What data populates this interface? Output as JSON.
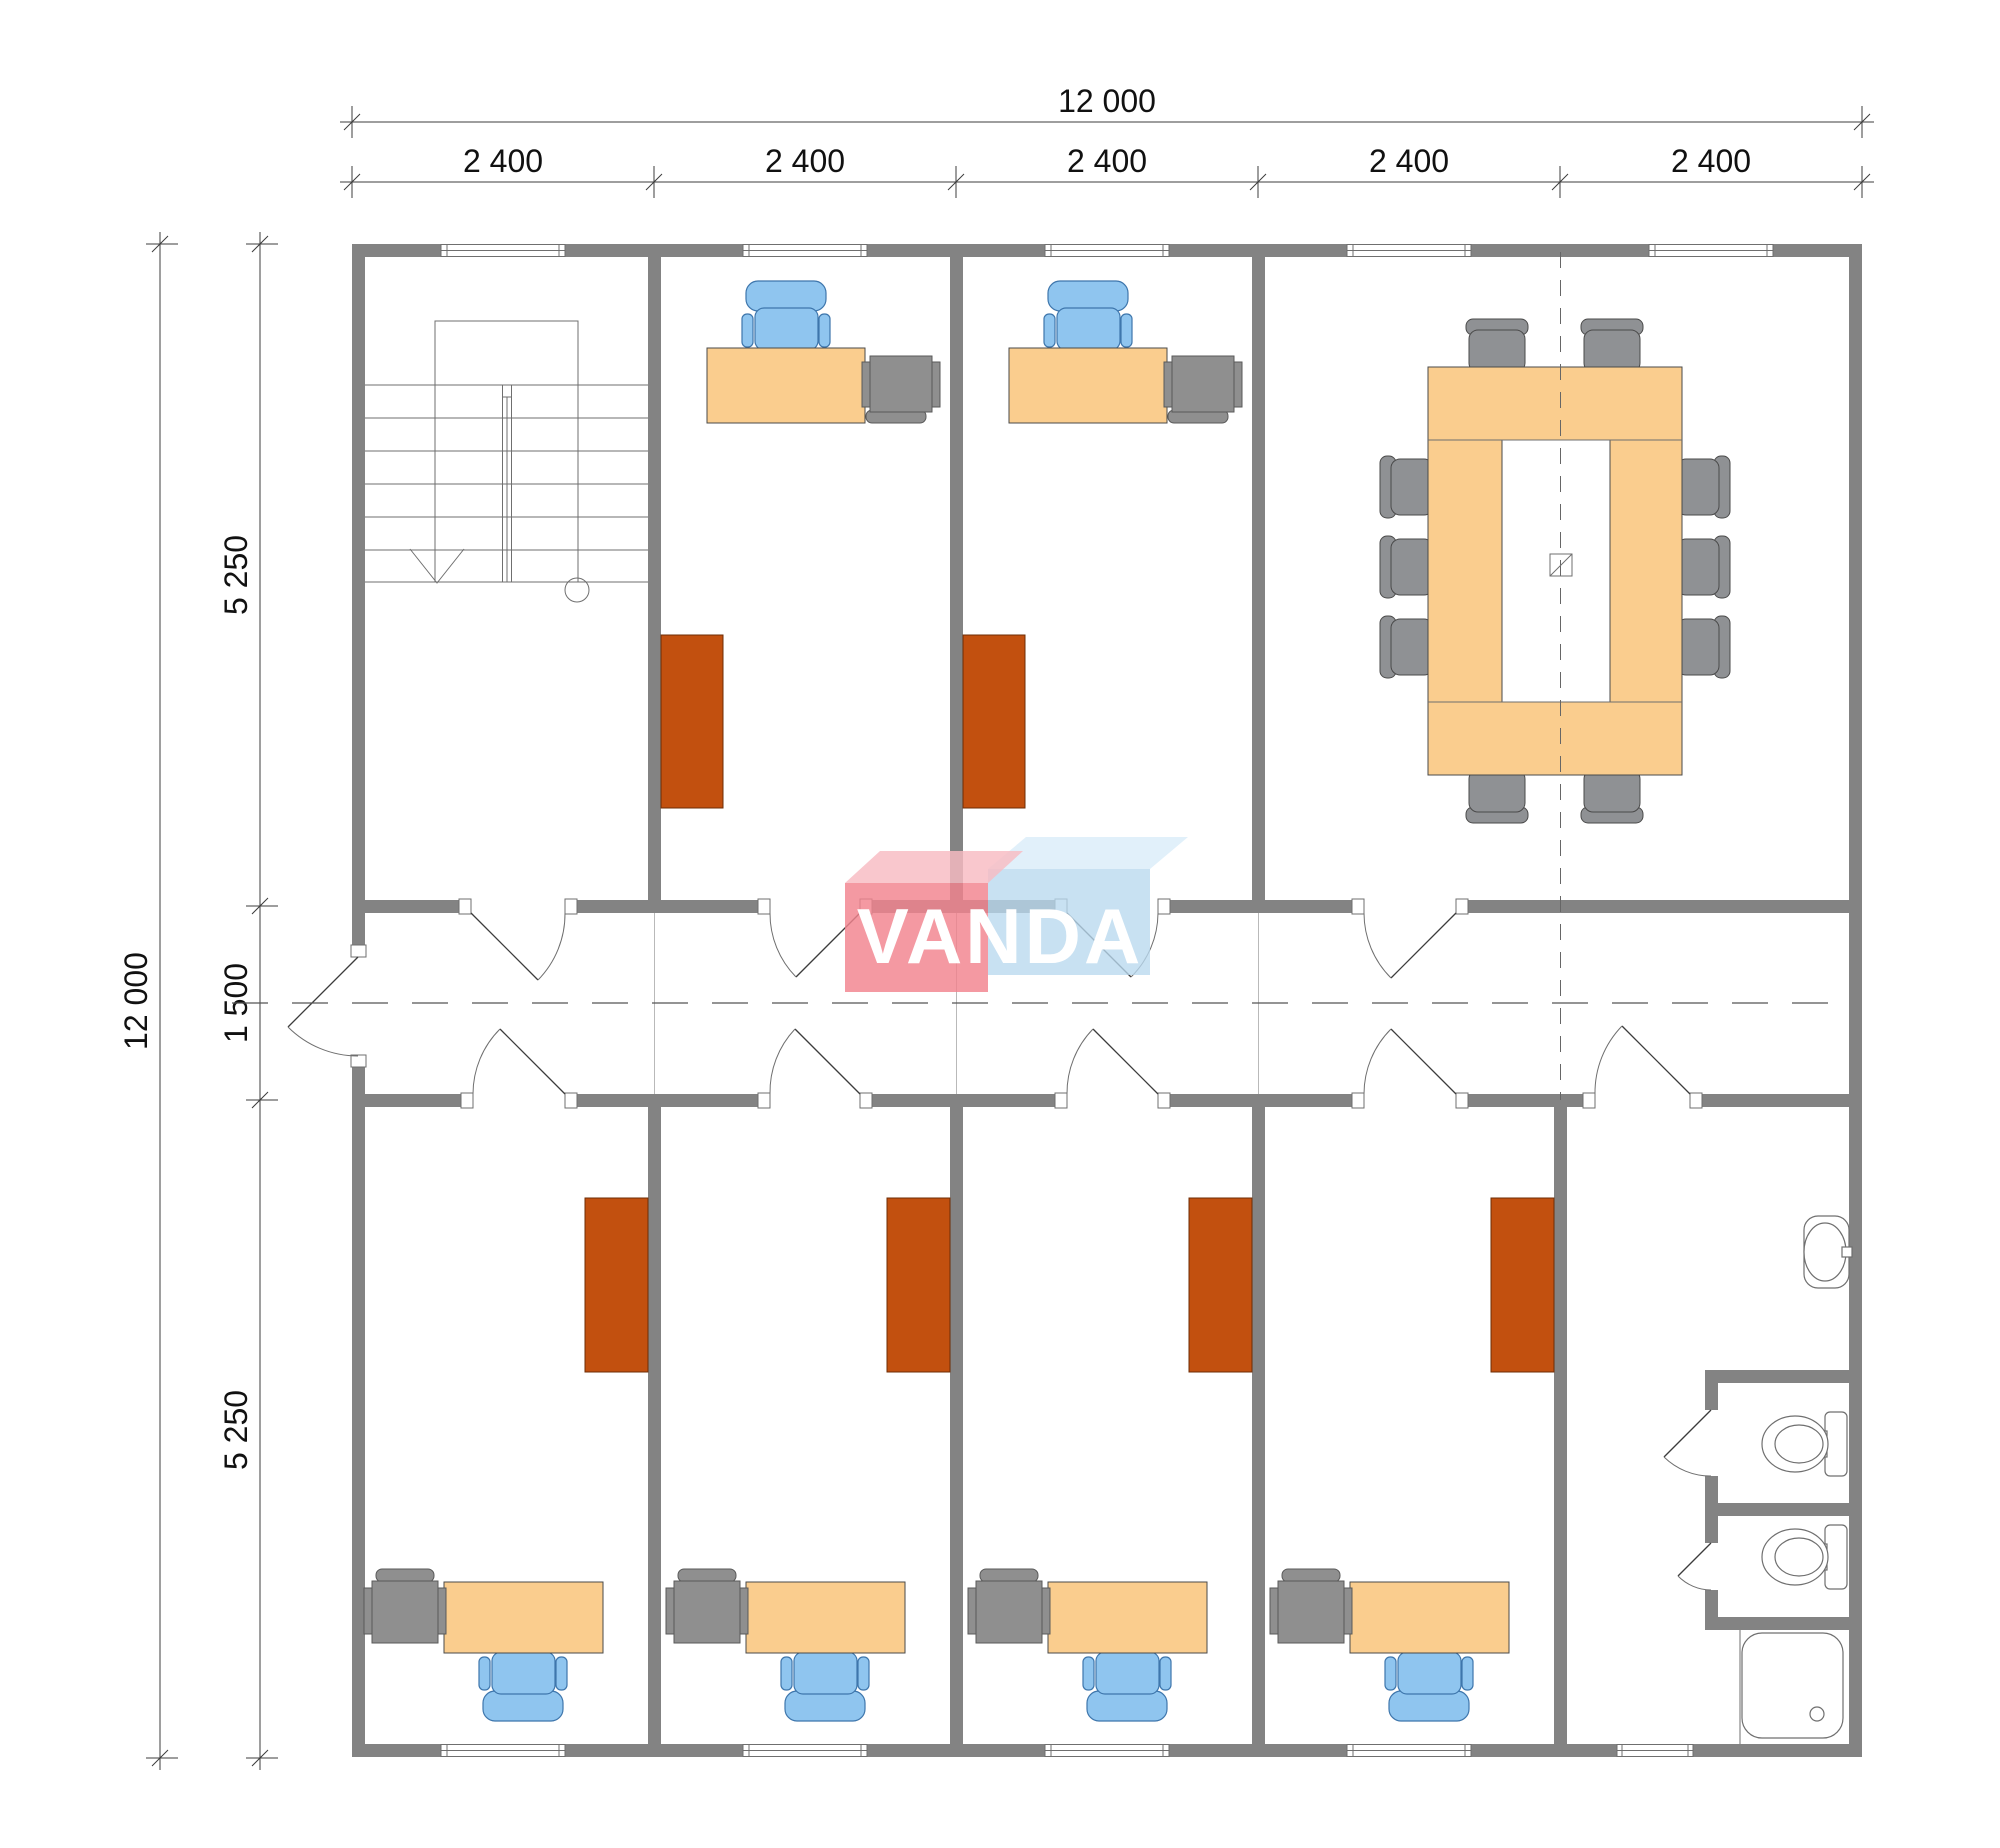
{
  "drawing": {
    "type": "office-floor-plan"
  },
  "dimensions": {
    "top_total": "12 000",
    "top_segments": [
      "2 400",
      "2 400",
      "2 400",
      "2 400",
      "2 400"
    ],
    "left_total": "12 000",
    "left_segments": [
      "5 250",
      "1 500",
      "5 250"
    ]
  },
  "logo": {
    "text": "VANDA"
  },
  "colors": {
    "wall": "#838383",
    "desk": "#FACD8E",
    "chair": "#8FC5EF",
    "chair_border": "#3E76AC",
    "cabinet": "#C2500F",
    "cabinet_border": "#6E2D05",
    "meeting_chair": "#8F9194",
    "pc": "#8F8F8F",
    "pc_border": "#5A5A5A",
    "furniture_border": "#4A4A4A",
    "line_dark": "#3C3C3C",
    "line_med": "#6F6F6F",
    "logo_red": "#F2828E",
    "logo_red_top": "#F8BBC2",
    "logo_blue": "#B9D8EE",
    "logo_blue_top": "#D9ECF8",
    "logo_text": "#FFFFFF"
  }
}
